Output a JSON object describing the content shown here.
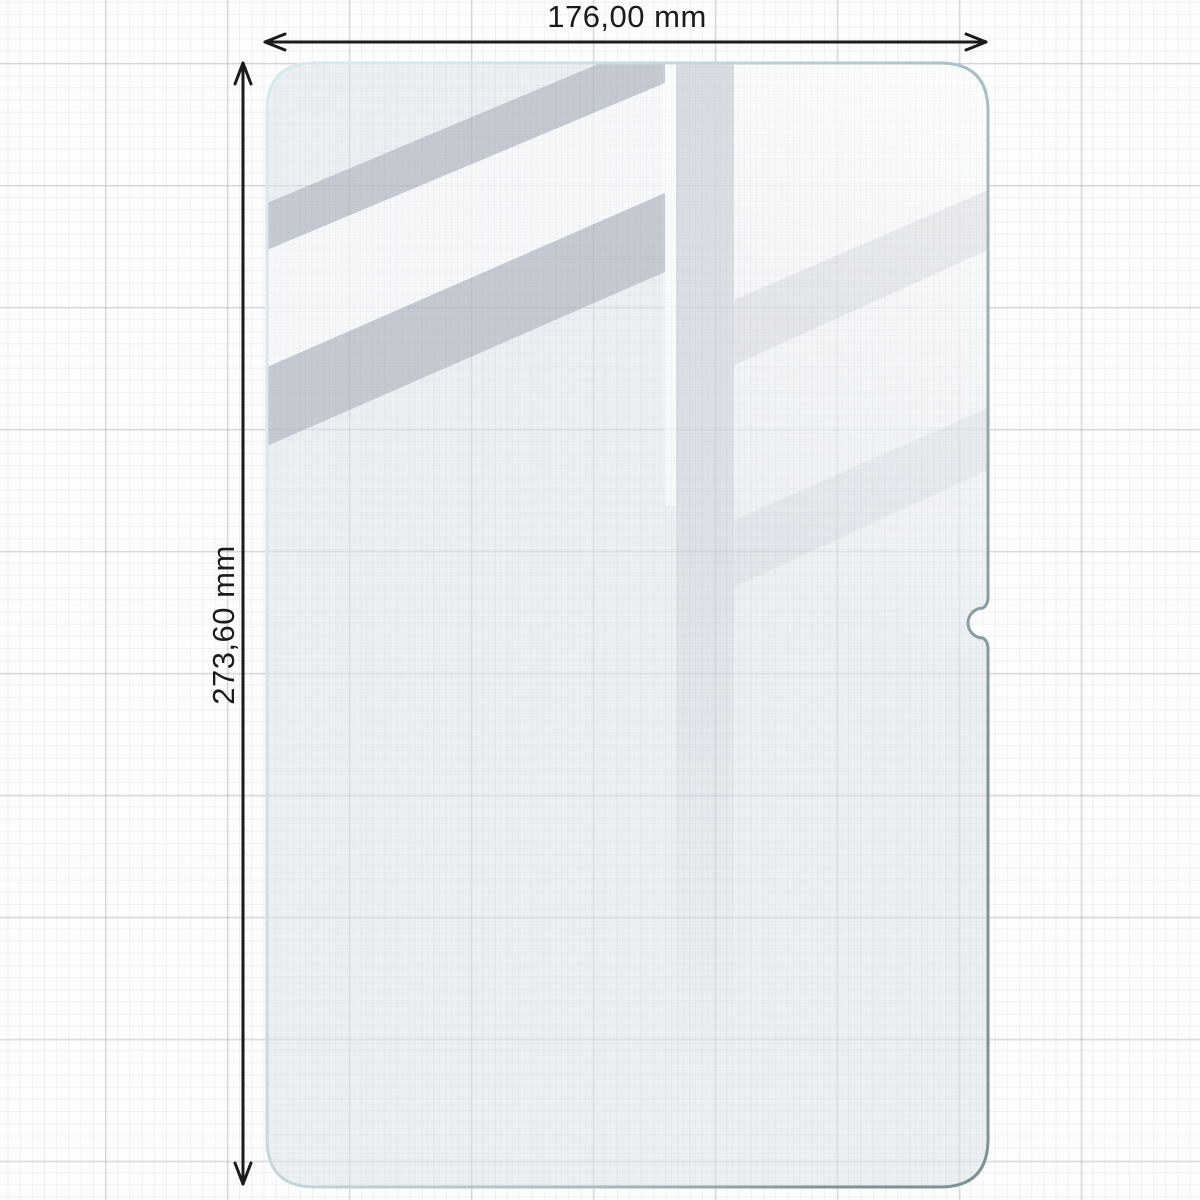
{
  "diagram": {
    "width_label": "176,00 mm",
    "height_label": "273,60 mm"
  },
  "icons": {
    "width_arrow": "double-headed-horizontal-arrow-icon",
    "height_arrow": "double-headed-vertical-arrow-icon"
  },
  "colors": {
    "paper": "#fdfdfd",
    "grid_fine": "rgba(125,135,148,0.10)",
    "grid_major": "rgba(105,115,128,0.22)",
    "dimension_line": "#1b1b1d",
    "glass_border_light": "#d6eaee",
    "glass_border_mid": "#a9bec2",
    "glass_border_dark": "#7d9396",
    "glass_fill": "rgba(222,227,233,0.50)",
    "reflection_gray": "rgba(148,155,170,0.45)",
    "reflection_white": "rgba(255,255,255,0.55)"
  }
}
